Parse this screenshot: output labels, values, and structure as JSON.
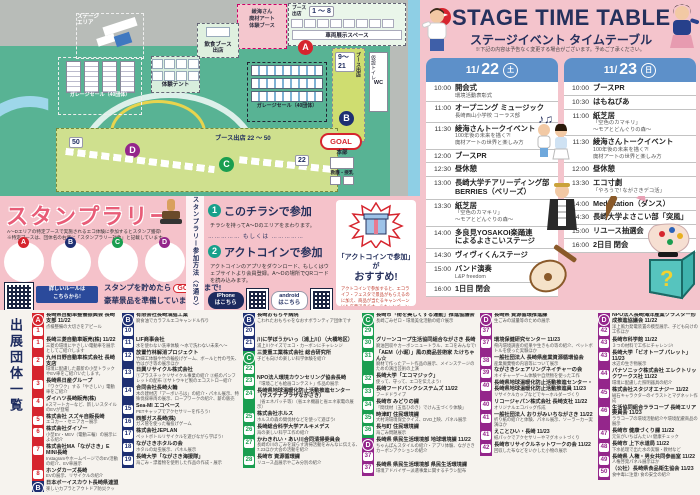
{
  "map": {
    "venue_tag": "会場",
    "venue_name": "長崎\n水辺の森公園",
    "stage_area": "ステージ\nエリア",
    "ayami_booth": "綾海さん\n廃材アート\n体験ブース",
    "food_booth": "飲食ブース\n出店",
    "tent": "体験テント",
    "garage1": "ガレージセール（40団体）",
    "garage2": "ガレージセール（40団体）",
    "booth_label": "ブース\n出店",
    "booth_1_8": "1 ～ 8",
    "vehicle_space": "車両展示スペース",
    "booth_9_21": "9～21",
    "booth_side_label": "ブース出店",
    "toilet": "仮設トイレ",
    "wc": "WC",
    "booth_22_50": "ブース出店 22 ～ 50",
    "chip50": "50",
    "chip22": "22",
    "goal": "GOAL",
    "hq": "本部",
    "aid": "救護・授乳",
    "markers": {
      "a": "A",
      "b": "B",
      "c": "C",
      "d": "D"
    }
  },
  "stage": {
    "title": "STAGE TIME TABLE",
    "subtitle": "ステージイベント タイムテーブル",
    "note": "※下記の内容は予告なく変更する場合がございます。予めご了承ください。",
    "days": [
      {
        "month": "11/",
        "day": "22",
        "dow": "土",
        "rows": [
          {
            "t": "10:00",
            "title": "開会式",
            "sub": "環境活動表彰式"
          },
          {
            "t": "11:00",
            "title": "オープニング ミュージック",
            "sub": "長崎西山小学校 コーラス部"
          },
          {
            "t": "11:30",
            "title": "綾海さんトークイベント",
            "sub": "100年後の未来を描く?!\n廃材アートの世界と楽しみ方"
          },
          {
            "t": "12:00",
            "title": "ブースPR"
          },
          {
            "t": "12:30",
            "title": "昼休憩"
          },
          {
            "t": "13:00",
            "title": "長崎大学チアリーディング部\nBERRIES（ベリーズ）"
          },
          {
            "t": "13:30",
            "title": "紙芝居",
            "sub": "「空色のカマキリ」\n～モアとどんぐりの森～"
          },
          {
            "t": "14:00",
            "title": "多良見YOSAKOI楽踊連\nによるよさこいステージ"
          },
          {
            "t": "14:30",
            "title": "ヴィヴィくんステージ"
          },
          {
            "t": "15:00",
            "title": "バンド演奏",
            "sub": "L&P freedom"
          },
          {
            "t": "16:00",
            "title": "1日目 閉会"
          }
        ]
      },
      {
        "month": "11/",
        "day": "23",
        "dow": "日",
        "rows": [
          {
            "t": "10:00",
            "title": "ブースPR"
          },
          {
            "t": "10:30",
            "title": "はもねびあ"
          },
          {
            "t": "11:00",
            "title": "紙芝居",
            "sub": "「空色のカマキリ」\n～モアとどんぐりの森～"
          },
          {
            "t": "11:30",
            "title": "綾海さんトークイベント",
            "sub": "100年後の未来を描く?!\n廃材アートの世界と楽しみ方"
          },
          {
            "t": "12:00",
            "title": "昼休憩"
          },
          {
            "t": "13:30",
            "title": "エコ寸劇",
            "sub": "「やろうで! ながさきデコ活」"
          },
          {
            "t": "14:00",
            "title": "Medistation（ダンス）"
          },
          {
            "t": "14:30",
            "title": "長崎大学よさこい部「突風」"
          },
          {
            "t": "15:00",
            "title": "リユース抽選会"
          },
          {
            "t": "16:00",
            "title": "2日目 閉会"
          }
        ]
      }
    ]
  },
  "stamp_rally": {
    "title": "スタンプラリー",
    "note1": "A～Dエリアの特定ブースで実施されるエコ体験に参加するとスタンプ獲得!",
    "note2": "※特定ブースは、団体名の右側に「スタンプラリー対象」と記載しています。",
    "circles": [
      "A",
      "B",
      "C",
      "D"
    ],
    "rule_caption": "詳しいルールは\nこちらから!",
    "goal_pre": "スタンプを貯めたら",
    "goal_word": "GOAL",
    "goal_post": "まで!",
    "goal_line2": "豪華景品を準備しています!",
    "method_vertical": "スタンプラリー参加方法〈2通り〉",
    "m1_num": "1",
    "m1_title": "このチラシで参加",
    "m1_desc": "チラシを持ってA～Dのエリアをまわります。",
    "or_label": "…………… もしくは ……………",
    "m2_num": "2",
    "m2_title": "アクトコインで参加",
    "m2_desc": "アクトコインのアプリをダウンロード、もしくはウェブサイトより会員登録。A～Dの場所でQRコードを読み込みます。",
    "iphone_label": "iPhone\nはこちら",
    "android_label": "android\nはこちら",
    "reco_title": "「アクトコインで参加」が",
    "reco_big": "おすすめ!",
    "reco_desc": "アクトコインで参加すると、エコライフ・フェスタで景品がもらえるのに加え、商品が当たるキャンペーンにも応募できます。※キャンペーン詳細は特設画面にて"
  },
  "exhibitors": {
    "heading": "出展団体一覧",
    "columns": [
      {
        "entries": [
          {
            "n": "1",
            "sec": "A",
            "badge": "A",
            "name": "長崎県自動車整備振興会 長崎支部 11/22",
            "desc": "点検整備の大切さをアピール"
          },
          {
            "n": "1",
            "sec": "A",
            "name": "長崎三菱自動車販売(株) 11/22",
            "desc": "三菱の環境にやさしい電動車を展示としてご紹介します"
          },
          {
            "n": "2",
            "sec": "A",
            "name": "九州日野自動車株式会社 長崎支店",
            "desc": "環境に配慮した最新の小型トラックやEV車をご紹介いたします。"
          },
          {
            "n": "3",
            "sec": "A",
            "name": "長崎県日産グループ",
            "desc": "「ワクワク」する「やさしい」電動車をご紹介"
          },
          {
            "n": "4",
            "sec": "A",
            "name": "ダイハツ長崎販売(株)",
            "desc": "eスマートカーなど、新しいスタイルのEVが登場"
          },
          {
            "n": "5",
            "sec": "A",
            "name": "株式会社 スズキ自販長崎",
            "desc": "エコカー・セニアカー展示"
          },
          {
            "n": "6",
            "sec": "A",
            "name": "株式会社ダイゾー",
            "desc": "小型EV・MEV（電動三輪）の展示による紹介"
          },
          {
            "n": "7",
            "sec": "A",
            "name": "株式会社MA「ながさき」E MINI長崎",
            "desc": "InstagramやホームページでのEV活動の紹介、EV車展示"
          },
          {
            "n": "8",
            "sec": "A",
            "name": "ホンダカーズ長崎",
            "desc": "EVの展示、リサイクルの紹介"
          },
          {
            "n": "9",
            "sec": "B",
            "badge": "B",
            "name": "日本ボーイスカウト長崎県連盟",
            "desc": "楽しいカプラとアウトドア防災クッキング"
          }
        ]
      },
      {
        "entries": [
          {
            "n": "10",
            "sec": "B",
            "badge": "B",
            "name": "有限会社長崎油脂工業",
            "desc": "廃食油でカラフルエコキャンドル作り"
          },
          {
            "n": "11",
            "sec": "B",
            "name": "LIF商事会社",
            "desc": "水を使わない洗車体験 ～水で洗わない未来へ～"
          },
          {
            "n": "12",
            "sec": "B",
            "name": "放置竹林解消プロジェクト",
            "desc": "竹細工体験や竹の輪投げゲーム、ボールと竹の弓矢、竹はがき等の展示ほか"
          },
          {
            "n": "13",
            "sec": "B",
            "name": "日興リサイクル株式会社",
            "desc": "①プラスチックリサイクル事業の紹介 ②紙のパンフレットの配布 ③サトウキビ製のエコストロー紹介"
          },
          {
            "n": "14",
            "sec": "B",
            "name": "合同会社長崎火輪",
            "desc": "木の建材店「アーボいろは」の紹介・パネル展示、特殊伐採車両の展示、ロープワークの紹介、薪の販売"
          },
          {
            "n": "15",
            "sec": "B",
            "name": "Sea-MI エコベース",
            "desc": "PETキャップでアクセサリーを作ろう!"
          },
          {
            "n": "16",
            "sec": "B",
            "name": "西部ガス長崎(株)",
            "desc": "ガス管を使った輪投げゲーム"
          },
          {
            "n": "17",
            "sec": "B",
            "name": "株式会社JEPLAN",
            "desc": "ペットボトルリサイクルを遊びながら学ぼう!"
          },
          {
            "n": "18",
            "sec": "B",
            "name": "ながさきホタルの会",
            "desc": "ホタルの幼虫展示、パネル展示"
          },
          {
            "n": "19",
            "sec": "B",
            "name": "長崎大学「ながさき海援隊」",
            "desc": "海ごみ・漂着物を使用した作品の作成・展示"
          }
        ]
      },
      {
        "entries": [
          {
            "n": "20",
            "sec": "B",
            "badge": "B",
            "name": "長崎おもちゃ病院",
            "desc": "こわれたおもちゃをなおすボランティア団体です"
          },
          {
            "n": "21",
            "sec": "B",
            "name": "川に学ぼうかいっ（浦上川）（大橋地区）",
            "desc": "浦上川クイズでエコ・カーボンにチャレンジ"
          },
          {
            "n": "22",
            "sec": "C",
            "badge": "C",
            "name": "三菱重工業株式会社 総合研究所",
            "desc": "子ども向けの楽しい科学体験を紹介"
          },
          {
            "n": "23",
            "sec": "C",
            "name": "NPO法人環境カウンセリング協会長崎",
            "desc": "「環境こども絵画コンテスト」作品の展示"
          },
          {
            "n": "24",
            "sec": "C",
            "name": "長崎県地球温暖化防止活動推進センター（サステナプラザながさき）",
            "desc": "（省エネパッチ等）（省エネ機器と省エネ家電の展示）"
          },
          {
            "n": "25",
            "sec": "C",
            "name": "株式会社ホルス",
            "desc": "ホルスの森の間伐材などを使って遊ぼう!"
          },
          {
            "n": "26",
            "sec": "C",
            "name": "長崎総合科学大学アルキメデス",
            "desc": "海の楽しい科学工作の紹介"
          },
          {
            "n": "27",
            "sec": "C",
            "name": "かわきれい・あい川合同清掃委員会",
            "desc": "長崎の川のごみを減らす清掃活動をみんなに伝える、7.23ほか大会の活動を紹介"
          },
          {
            "n": "28",
            "sec": "C",
            "name": "長崎市 資源循環課",
            "desc": "リユース品展示やごみ分別の紹介"
          }
        ]
      },
      {
        "entries": [
          {
            "n": "29",
            "sec": "C",
            "badge": "C",
            "name": "長崎市「街を美しくする運動」推進協議会",
            "desc": "長崎ごみゼロ・環境美化活動の紹介展示"
          },
          {
            "n": "30",
            "sec": "C",
            "name": "グリーンコープ生活協同組合ながさき 長崎",
            "desc": "廃油回収やカーボンニュートラル、エコをみんなで!"
          },
          {
            "n": "31",
            "sec": "C",
            "name": "「AEM（小堀）」風の廃品芸術家 たけちゃん☆",
            "desc": "廃材で作ったアート作品の展示、メインステージのための演出芸術の上演"
          },
          {
            "n": "32",
            "sec": "C",
            "name": "長崎大学「エコマジック」",
            "desc": "使って、守って、エコを伝えよう!"
          },
          {
            "n": "33",
            "sec": "C",
            "name": "長崎フードバンクシステムズ 11/22",
            "desc": "フードドライブ"
          },
          {
            "n": "34",
            "sec": "C",
            "name": "長崎市 みどりの課",
            "desc": "「間伐材（五島ひのき）でけん玉づくり体験」"
          },
          {
            "n": "35",
            "sec": "C",
            "name": "時津町 住民環境課",
            "desc": "大村湾環境保全クイズ、DVD上映、パネル展示"
          },
          {
            "n": "36",
            "sec": "C",
            "name": "長与町 住民環境課",
            "desc": "海ごみ問題展示"
          },
          {
            "n": "37",
            "sec": "D",
            "badge": "D",
            "name": "長崎県 県民生活環境部 地球環境課 11/22",
            "desc": "ちゃんぽんスタイルの紹介・アプリ体験、ながさきカーボンアクションの紹介"
          },
          {
            "n": "37",
            "sec": "D",
            "name": "長崎県 県民生活環境部 県民生活環境課",
            "desc": "環境アドバイザー派遣事業に関するチラシ配布"
          }
        ]
      },
      {
        "entries": [
          {
            "n": "37",
            "sec": "D",
            "badge": "D",
            "name": "長崎県 資源循環推進課",
            "desc": "生ごみの減量等のための展示"
          },
          {
            "n": "37",
            "sec": "D",
            "name": "環境保健研究センター 11/23",
            "desc": "県内環境調査の結果や生きもの等の紹介、ペットボトルを使った実験ほか"
          },
          {
            "n": "38",
            "sec": "D",
            "name": "一般社団法人 長崎県産業資源循環協会",
            "desc": "産業廃棄物の内容等について展示"
          },
          {
            "n": "39",
            "sec": "D",
            "name": "ながさきシェアリングネイチャーの会",
            "desc": "ネイチャーゲーム体験や自然物を使った工作"
          },
          {
            "n": "40",
            "sec": "D",
            "name": "長崎県地球温暖化防止活動推進センター・長崎県地球温暖化防止活動推進員 11/23",
            "desc": "リサイクルカップなどでキーホルダーづくり"
          },
          {
            "n": "40",
            "sec": "D",
            "name": "リコージャパン株式会社 長崎支社 11/22",
            "desc": "オリジナルエコバッグ作成"
          },
          {
            "n": "41",
            "sec": "D",
            "name": "一般社団法人 おりがみいちながさき 11/22",
            "desc": "折り紙の紹介と体験、パネル展示、ソーラーカー実演ほか"
          },
          {
            "n": "41",
            "sec": "D",
            "name": "えことひい・長崎 11/23",
            "desc": "紙パックでアクセサリーやマグネットづくり"
          },
          {
            "n": "42",
            "sec": "D",
            "name": "長崎市リサイクルネットワークの会 11/22",
            "desc": "回収した布などをいかした小物の展示"
          }
        ]
      },
      {
        "entries": [
          {
            "n": "42",
            "sec": "D",
            "badge": "D",
            "name": "NPO法人長崎海洋産業クラスター形成推進協議会 11/22",
            "desc": "洋上風力発電装置の模型展示、子ども向けの工作ほか"
          },
          {
            "n": "43",
            "sec": "D",
            "name": "長崎市科学館 11/22",
            "desc": "３つの材料で工作にチャレンジ!"
          },
          {
            "n": "43",
            "sec": "D",
            "name": "長崎大学「ビオトープ パレット」11/23",
            "desc": "水辺の生き物展示"
          },
          {
            "n": "44",
            "sec": "D",
            "name": "パナソニック株式会社 エレクトリックワークス社 11/22",
            "desc": "環境に配慮した照明器具の紹介"
          },
          {
            "n": "45",
            "sec": "D",
            "name": "株式会社スタジオエナジー 11/22",
            "desc": "磁石キャラクターのイラストとマグネット作成"
          },
          {
            "n": "46",
            "sec": "D",
            "name": "生活協同組合ララコープ 長崎エリア委員会 11/23",
            "desc": "ララコープの環境活動紹介や環境配慮商品の展示"
          },
          {
            "n": "47",
            "sec": "D",
            "name": "長崎市 健康づくり課 11/22",
            "desc": "元気がいちばんたい! 健康チェック"
          },
          {
            "n": "48",
            "sec": "D",
            "name": "長崎市 上下水道局 11/22",
            "desc": "下水処理で出た水の実験・教材など"
          },
          {
            "n": "49",
            "sec": "D",
            "name": "長崎県 人権・男女共同参画室 11/22",
            "desc": "人権啓発パネル展示ほか"
          },
          {
            "n": "50",
            "sec": "D",
            "name": "（公社）長崎県食品衛生協会 11/23",
            "desc": "食中毒に注意! 食の安全の紹介"
          }
        ]
      }
    ]
  }
}
